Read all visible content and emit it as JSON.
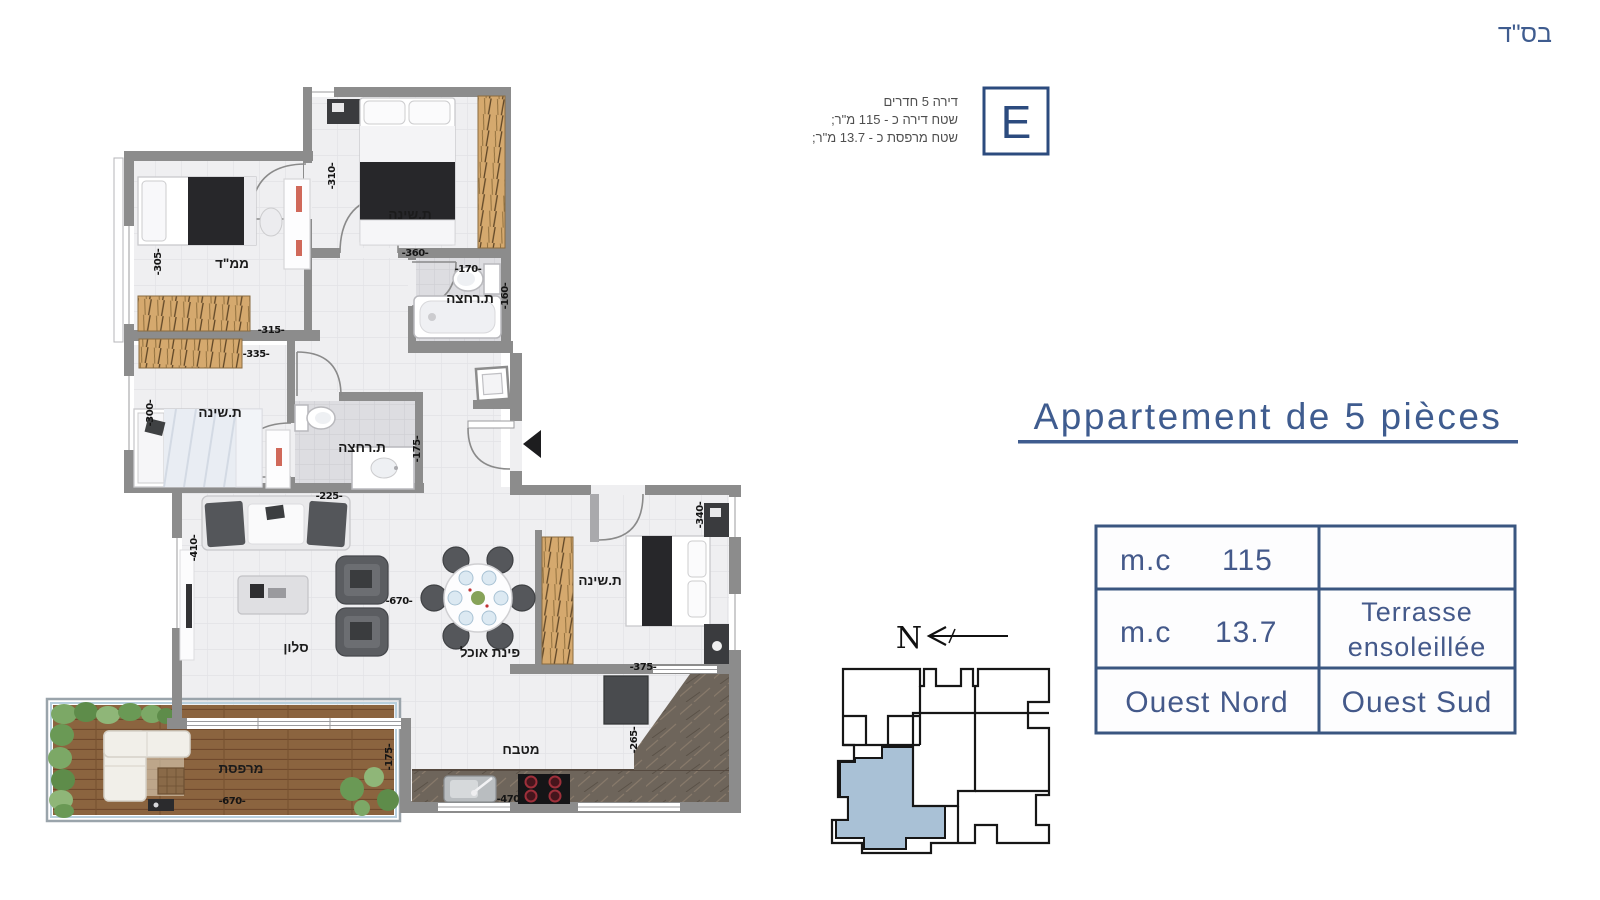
{
  "header": {
    "bsd": "בס\"ד"
  },
  "unit_badge": {
    "letter": "E",
    "info_lines": [
      "דירה 5 חדרים",
      "שטח דירה כ - 115 מ\"ר;",
      "שטח מרפסת כ - 13.7 מ\"ר;"
    ]
  },
  "title": {
    "text": "Appartement de 5 pièces"
  },
  "spec_table": {
    "row1": {
      "label": "m.c",
      "value": "115",
      "right": ""
    },
    "row2": {
      "label": "m.c",
      "value": "13.7",
      "right_line1": "Terrasse",
      "right_line2": "ensoleillée"
    },
    "row3": {
      "left": "Ouest Nord",
      "right": "Ouest Sud"
    }
  },
  "compass": {
    "north_label": "N"
  },
  "floor_plan": {
    "rooms": {
      "bedroom_top": "ת.שינה",
      "mamad": "ממ\"ד",
      "bathroom_top": "ת.רחצה",
      "bedroom_left": "ת.שינה",
      "bathroom_mid": "ת.רחצה",
      "living": "סלון",
      "dining": "פינת אוכל",
      "kitchen": "מטבח",
      "bedroom_right": "ת.שינה",
      "terrace": "מרפסת"
    },
    "dimensions": {
      "d310": "-310-",
      "d360": "-360-",
      "d305": "-305-",
      "d315": "-315-",
      "d335": "-335-",
      "d300": "-300-",
      "d170": "-170-",
      "d160": "-160-",
      "d175a": "-175-",
      "d225": "-225-",
      "d410": "-410-",
      "d670a": "-670-",
      "d340": "-340-",
      "d375a": "-375-",
      "d265": "-265-",
      "d470": "-470-",
      "d670b": "-670-",
      "d175b": "-175-"
    }
  },
  "colors": {
    "accent_blue": "#3F5C8F",
    "keyplan_highlight": "#A9C1D6",
    "wall_gray": "#8C8C8C"
  }
}
